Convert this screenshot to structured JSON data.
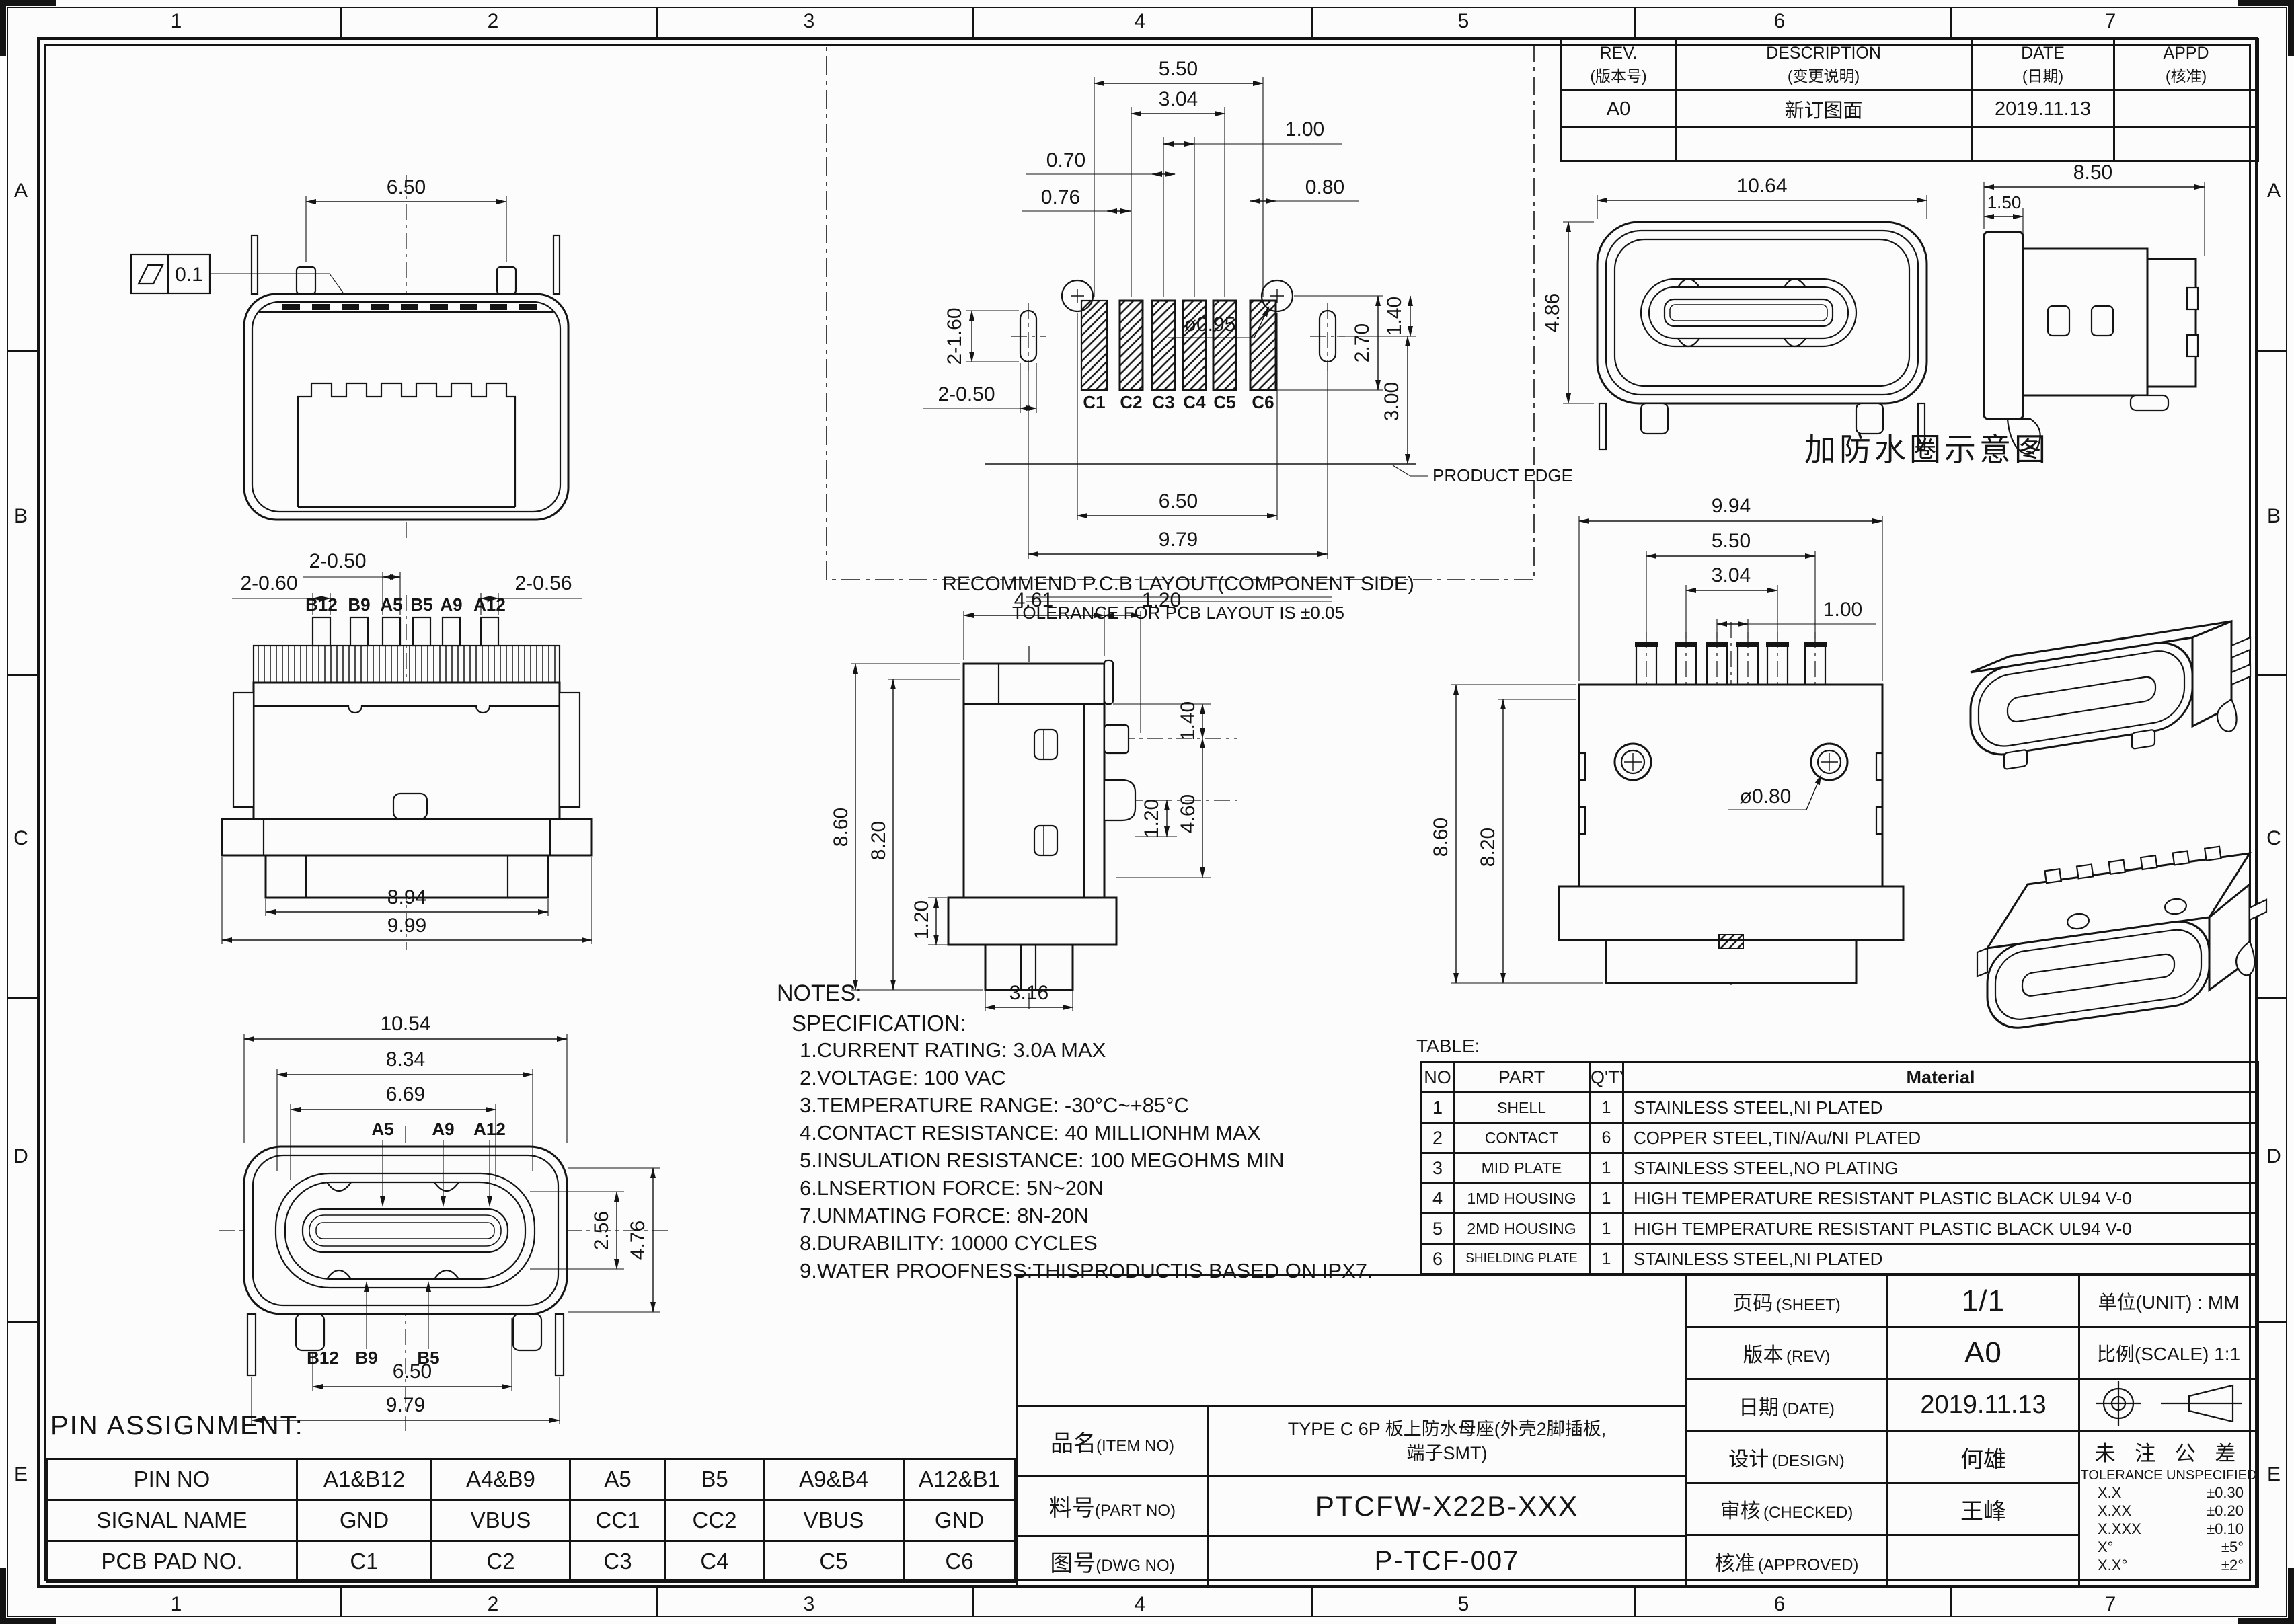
{
  "frame": {
    "cols": [
      "1",
      "2",
      "3",
      "4",
      "5",
      "6",
      "7"
    ],
    "rows": [
      "A",
      "B",
      "C",
      "D",
      "E"
    ]
  },
  "revision_table": {
    "headers": [
      {
        "en": "REV.",
        "zh": "(版本号)"
      },
      {
        "en": "DESCRIPTION",
        "zh": "(变更说明)"
      },
      {
        "en": "DATE",
        "zh": "(日期)"
      },
      {
        "en": "APPD",
        "zh": "(核准)"
      }
    ],
    "rows": [
      [
        "A0",
        "新订图面",
        "2019.11.13",
        ""
      ],
      [
        "",
        "",
        "",
        ""
      ]
    ]
  },
  "parts_table": {
    "label": "TABLE:",
    "headers": [
      "NO",
      "PART",
      "Q'TY",
      "Material"
    ],
    "rows": [
      [
        "1",
        "SHELL",
        "1",
        "STAINLESS STEEL,NI PLATED"
      ],
      [
        "2",
        "CONTACT",
        "6",
        "COPPER STEEL,TIN/Au/NI PLATED"
      ],
      [
        "3",
        "MID PLATE",
        "1",
        "STAINLESS STEEL,NO PLATING"
      ],
      [
        "4",
        "1MD HOUSING",
        "1",
        "HIGH TEMPERATURE RESISTANT PLASTIC BLACK UL94 V-0"
      ],
      [
        "5",
        "2MD HOUSING",
        "1",
        "HIGH TEMPERATURE RESISTANT PLASTIC BLACK UL94 V-0"
      ],
      [
        "6",
        "SHIELDING PLATE",
        "1",
        "STAINLESS STEEL,NI PLATED"
      ]
    ]
  },
  "notes": {
    "title": "NOTES:",
    "subtitle": "SPECIFICATION:",
    "items": [
      "1.CURRENT RATING: 3.0A MAX",
      "2.VOLTAGE: 100 VAC",
      "3.TEMPERATURE RANGE: -30°C~+85°C",
      "4.CONTACT RESISTANCE: 40 MILLIONHM MAX",
      "5.INSULATION RESISTANCE: 100 MEGOHMS MIN",
      "6.LNSERTION FORCE: 5N~20N",
      "7.UNMATING FORCE: 8N-20N",
      "8.DURABILITY: 10000 CYCLES",
      "9.WATER PROOFNESS:THISPRODUCTIS BASED ON IPX7."
    ]
  },
  "pin_table": {
    "title": "PIN ASSIGNMENT:",
    "rows": [
      [
        "PIN NO",
        "A1&B12",
        "A4&B9",
        "A5",
        "B5",
        "A9&B4",
        "A12&B1"
      ],
      [
        "SIGNAL NAME",
        "GND",
        "VBUS",
        "CC1",
        "CC2",
        "VBUS",
        "GND"
      ],
      [
        "PCB PAD NO.",
        "C1",
        "C2",
        "C3",
        "C4",
        "C5",
        "C6"
      ]
    ]
  },
  "title_block": {
    "item_label_zh": "品名",
    "item_label_en": "(ITEM NO)",
    "item_value_l1": "TYPE C 6P 板上防水母座(外壳2脚插板,",
    "item_value_l2": "端子SMT)",
    "part_label_zh": "料号",
    "part_label_en": "(PART NO)",
    "part_value": "PTCFW-X22B-XXX",
    "dwg_label_zh": "图号",
    "dwg_label_en": "(DWG NO)",
    "dwg_value": "P-TCF-007",
    "sheet_label_zh": "页码",
    "sheet_label_en": "(SHEET)",
    "sheet_value": "1/1",
    "unit_label": "单位(UNIT) : MM",
    "rev_label_zh": "版本",
    "rev_label_en": "(REV)",
    "rev_value": "A0",
    "scale_label": "比例(SCALE) 1:1",
    "date_label_zh": "日期",
    "date_label_en": "(DATE)",
    "date_value": "2019.11.13",
    "design_label_zh": "设计",
    "design_label_en": "(DESIGN)",
    "design_value": "何雄",
    "checked_label_zh": "审核",
    "checked_label_en": "(CHECKED)",
    "checked_value": "王峰",
    "approved_label_zh": "核准",
    "approved_label_en": "(APPROVED)",
    "approved_value": "",
    "tol_title_zh": "未 注 公 差",
    "tol_title_en": "TOLERANCE UNSPECIFIED",
    "tolerances": [
      [
        "X.X",
        "±0.30"
      ],
      [
        "X.XX",
        "±0.20"
      ],
      [
        "X.XXX",
        "±0.10"
      ],
      [
        "X°",
        "±5°"
      ],
      [
        "X.X°",
        "±2°"
      ]
    ]
  },
  "views": {
    "tl": {
      "d650": "6.50",
      "flat": "0.1"
    },
    "pcb": {
      "d550": "5.50",
      "d304": "3.04",
      "d100": "1.00",
      "d070": "0.70",
      "d076": "0.76",
      "d080": "0.80",
      "d2160": "2-1.60",
      "d270": "2.70",
      "d140": "1.40",
      "d095": "ø0.95",
      "d2050": "2-0.50",
      "d300": "3.00",
      "d650": "6.50",
      "d979": "9.79",
      "edge": "PRODUCT EDGE",
      "cap1": "RECOMMEND P.C.B LAYOUT(COMPONENT SIDE)",
      "cap2": "TOLERANCE FOR PCB LAYOUT IS ±0.05",
      "pads": [
        "C1",
        "C2",
        "C3",
        "C4",
        "C5",
        "C6"
      ]
    },
    "tr": {
      "d1064": "10.64",
      "d486": "4.86",
      "d850": "8.50",
      "d150": "1.50",
      "caption": "加防水圈示意图"
    },
    "ml": {
      "d2050": "2-0.50",
      "d2060": "2-0.60",
      "d2056": "2-0.56",
      "d894": "8.94",
      "d999": "9.99",
      "pins": [
        "B12",
        "B9",
        "A5",
        "B5",
        "A9",
        "A12"
      ]
    },
    "mc": {
      "d461": "4.61",
      "d120a": "1.20",
      "d860": "8.60",
      "d820": "8.20",
      "d140": "1.40",
      "d120b": "1.20",
      "d460": "4.60",
      "d120c": "1.20",
      "d316": "3.16"
    },
    "mr": {
      "d994": "9.94",
      "d550": "5.50",
      "d304": "3.04",
      "d100": "1.00",
      "d860": "8.60",
      "d820": "8.20",
      "d080": "ø0.80"
    },
    "bl": {
      "d1054": "10.54",
      "d834": "8.34",
      "d669": "6.69",
      "d256": "2.56",
      "d476": "4.76",
      "d650": "6.50",
      "d979": "9.79",
      "top_pins": [
        "A5",
        "A9",
        "A12"
      ],
      "bot_pins": [
        "B12",
        "B9",
        "B5"
      ]
    }
  }
}
